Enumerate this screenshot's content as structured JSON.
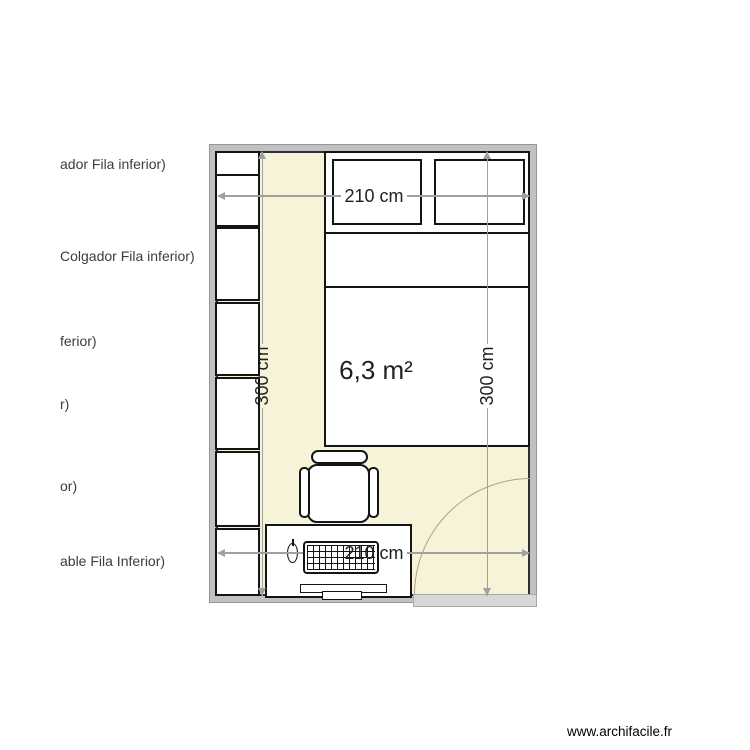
{
  "watermark": "www.archifacile.fr",
  "plan": {
    "area_label": "6,3 m²",
    "dimensions": {
      "top": "210 cm",
      "bottom": "210 cm",
      "left": "300 cm",
      "right": "300 cm"
    },
    "furniture_labels": [
      "ador Fila inferior)",
      "Colgador Fila inferior)",
      "ferior)",
      "r)",
      "or)",
      "able Fila Inferior)"
    ],
    "colors": {
      "floor": "#f7f3d8",
      "wall": "#c1c1c1",
      "wall_edge": "#303030",
      "dimension_line": "#a0a0a0",
      "door": "#d8d8d8",
      "door_arc": "#a9a489",
      "ink": "#1f1f1f"
    }
  }
}
